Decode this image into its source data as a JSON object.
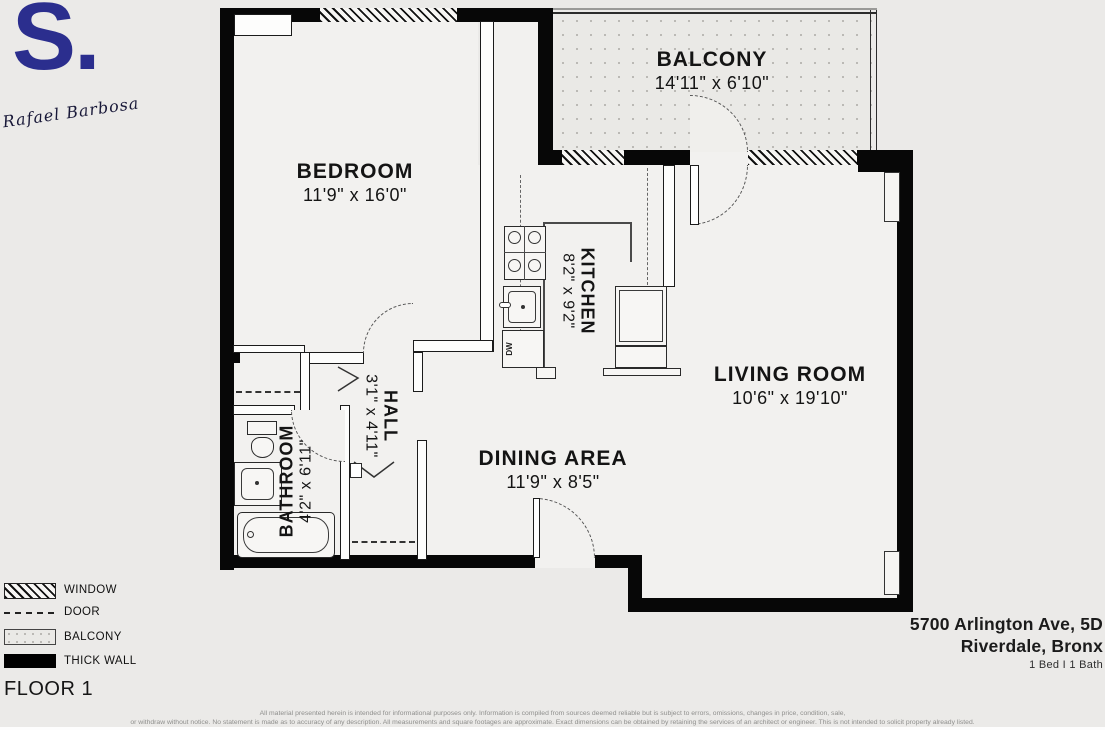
{
  "branding": {
    "logo_text": "S.",
    "signature": "Rafael Barbosa",
    "logo_color": "#2b2e8e"
  },
  "plan": {
    "rooms": [
      {
        "name": "BEDROOM",
        "dims": "11'9\" x 16'0\""
      },
      {
        "name": "BALCONY",
        "dims": "14'11\" x 6'10\""
      },
      {
        "name": "KITCHEN",
        "dims": "8'2\" x 9'2\""
      },
      {
        "name": "LIVING ROOM",
        "dims": "10'6\" x 19'10\""
      },
      {
        "name": "HALL",
        "dims": "3'1\" x 4'11\""
      },
      {
        "name": "BATHROOM",
        "dims": "4'2\" x 6'11\""
      },
      {
        "name": "DINING AREA",
        "dims": "11'9\" x 8'5\""
      }
    ],
    "fixtures": {
      "dishwasher_label": "DW"
    }
  },
  "legend": {
    "items": [
      {
        "label": "WINDOW"
      },
      {
        "label": "DOOR"
      },
      {
        "label": "BALCONY"
      },
      {
        "label": "THICK WALL"
      }
    ],
    "floor_label": "FLOOR 1"
  },
  "listing": {
    "address_line1": "5700 Arlington Ave, 5D",
    "address_line2": "Riverdale, Bronx",
    "beds_baths": "1 Bed I 1 Bath"
  },
  "disclaimer": {
    "line1": "All material presented herein is intended for informational purposes only. Information is compiled from sources deemed reliable but is subject to errors, omissions, changes in price, condition, sale,",
    "line2": "or withdraw without notice. No statement is made as to accuracy of any description. All measurements and square footages are approximate. Exact dimensions can be obtained by retaining the services of an architect or engineer. This is not intended to solicit property already listed."
  },
  "colors": {
    "wall": "#070707",
    "background": "#ebeae8",
    "floor": "#f2f1ef",
    "logo_blue": "#2b2e8e"
  }
}
